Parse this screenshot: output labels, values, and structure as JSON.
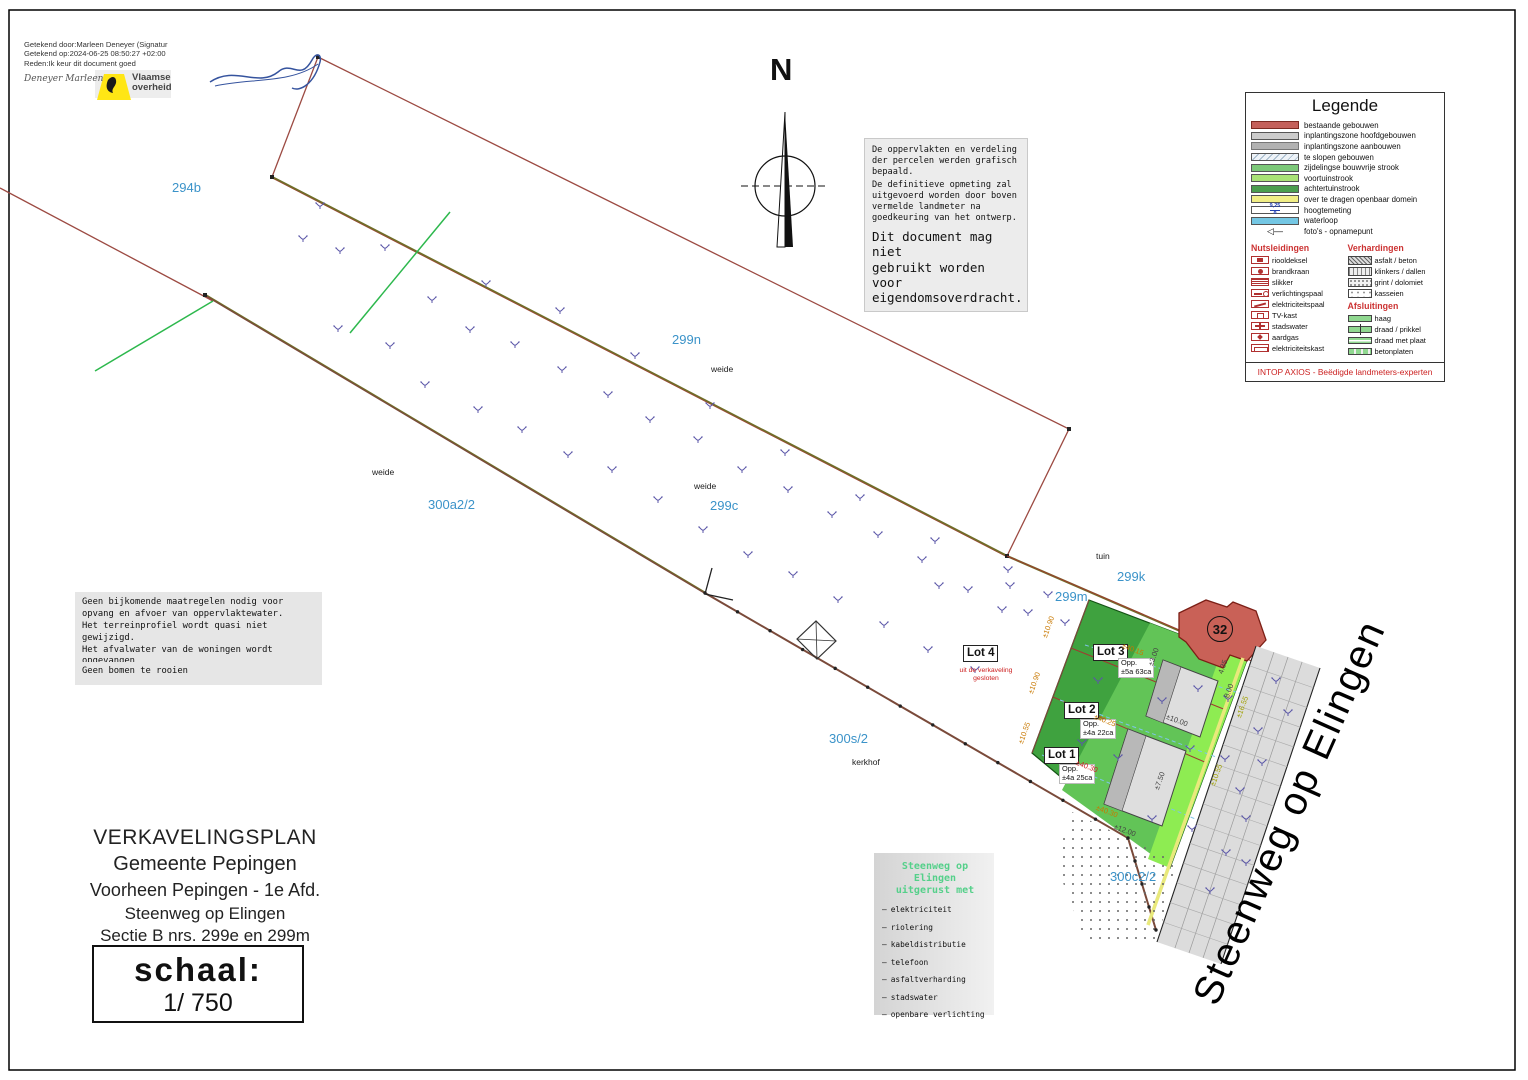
{
  "signature_block": {
    "lines": [
      "Getekend door:Marleen Deneyer (Signatur",
      "Getekend op:2024-06-25 08:50:27 +02:00",
      "Reden:Ik keur dit document goed"
    ],
    "handwritten_name": "Deneyer Marleen",
    "logo_line1": "Vlaamse",
    "logo_line2": "overheid"
  },
  "north": {
    "label": "N"
  },
  "notice_box": {
    "para1": "De oppervlakten en verdeling\nder percelen werden grafisch\nbepaald.",
    "para2": "De definitieve opmeting zal\nuitgevoerd worden door boven\nvermelde landmeter na\ngoedkeuring van het ontwerp.",
    "para3": "Dit document mag niet\ngebruikt worden voor\neigendomsoverdracht."
  },
  "legend": {
    "title": "Legende",
    "areas": [
      {
        "swatch": "sw-red",
        "label": "bestaande gebouwen"
      },
      {
        "swatch": "sw-gray1",
        "label": "inplantingszone hoofdgebouwen"
      },
      {
        "swatch": "sw-gray2",
        "label": "inplantingszone aanbouwen"
      },
      {
        "swatch": "sw-hatch",
        "label": "te slopen gebouwen"
      },
      {
        "swatch": "sw-green-mid",
        "label": "zijdelingse bouwvrije strook"
      },
      {
        "swatch": "sw-green-light",
        "label": "voortuinstrook"
      },
      {
        "swatch": "sw-green-dark",
        "label": "achtertuinstrook"
      },
      {
        "swatch": "sw-yellow",
        "label": "over te dragen openbaar domein"
      },
      {
        "swatch": "sw-hoogte",
        "note": "9,25|8",
        "label": "hoogtemeting"
      },
      {
        "swatch": "sw-blue",
        "label": "waterloop"
      },
      {
        "swatch": "sw-foto",
        "glyph": "◁—",
        "label": "foto's - opnamepunt"
      }
    ],
    "nutsleidingen": {
      "title": "Nutsleidingen",
      "items": [
        {
          "icon": "riooldeksel-icon",
          "cls": "ic-riool",
          "label": "riooldeksel"
        },
        {
          "icon": "brandkraan-icon",
          "cls": "ic-brand",
          "label": "brandkraan"
        },
        {
          "icon": "slikker-icon",
          "cls": "ic-slik",
          "label": "slikker"
        },
        {
          "icon": "verlichtingspaal-icon",
          "cls": "ic-verl",
          "label": "verlichtingspaal"
        },
        {
          "icon": "elektriciteitspaal-icon",
          "cls": "ic-epaal",
          "label": "elektriciteitspaal"
        },
        {
          "icon": "tv-kast-icon",
          "cls": "ic-tv",
          "label": "TV-kast"
        },
        {
          "icon": "stadswater-icon",
          "cls": "ic-water",
          "label": "stadswater"
        },
        {
          "icon": "aardgas-icon",
          "cls": "ic-gas",
          "label": "aardgas"
        },
        {
          "icon": "elektriciteitskast-icon",
          "cls": "ic-ekast",
          "label": "elektriciteitskast"
        }
      ]
    },
    "verhardingen": {
      "title": "Verhardingen",
      "items": [
        {
          "icon": "asfalt-beton-icon",
          "cls": "pat-hatch",
          "label": "asfalt / beton"
        },
        {
          "icon": "klinkers-dallen-icon",
          "cls": "pat-brick",
          "label": "klinkers / dallen"
        },
        {
          "icon": "grint-dolomiet-icon",
          "cls": "pat-dots",
          "label": "grint / dolomiet"
        },
        {
          "icon": "kasseien-icon",
          "cls": "pat-cobble",
          "label": "kasseien"
        }
      ]
    },
    "afsluitingen": {
      "title": "Afsluitingen",
      "items": [
        {
          "icon": "haag-icon",
          "cls": "",
          "label": "haag"
        },
        {
          "icon": "draad-prikkel-icon",
          "cls": "afs-draad",
          "label": "draad / prikkel"
        },
        {
          "icon": "draad-plaat-icon",
          "cls": "afs-plaat",
          "label": "draad met plaat"
        },
        {
          "icon": "betonplaten-icon",
          "cls": "afs-beton",
          "label": "betonplaten"
        }
      ]
    },
    "footer": "INTOP AXIOS - Beëdigde landmeters-experten"
  },
  "notes_box": {
    "para": "Geen bijkomende maatregelen nodig voor\nopvang en afvoer van oppervlaktewater.\nHet terreinprofiel wordt quasi niet gewijzigd.\nHet afvalwater van de woningen wordt opgevangen\nin de voorliggende riolering.",
    "para2": "Geen bomen te rooien"
  },
  "title_block": {
    "lines": [
      "VERKAVELINGSPLAN",
      "Gemeente Pepingen",
      "Voorheen Pepingen - 1e Afd.",
      "Steenweg op Elingen",
      "Sectie B nrs. 299e en 299m"
    ],
    "scale_label": "schaal:",
    "scale_value": "1/ 750"
  },
  "utilities_box": {
    "title_line1": "Steenweg op Elingen",
    "title_line2": "uitgerust met",
    "items": [
      "elektriciteit",
      "riolering",
      "kabeldistributie",
      "telefoon",
      "asfaltverharding",
      "stadswater",
      "openbare verlichting"
    ]
  },
  "map": {
    "street_label": {
      "text": "Steenweg op Elingen"
    },
    "building_number": "32",
    "labels": [
      {
        "text": "294b",
        "x": 172,
        "y": 180,
        "cls": "parcel"
      },
      {
        "text": "299n",
        "x": 672,
        "y": 332,
        "cls": "parcel"
      },
      {
        "text": "300a2/2",
        "x": 428,
        "y": 497,
        "cls": "parcel"
      },
      {
        "text": "299c",
        "x": 710,
        "y": 498,
        "cls": "parcel"
      },
      {
        "text": "299k",
        "x": 1117,
        "y": 569,
        "cls": "parcel"
      },
      {
        "text": "299m",
        "x": 1055,
        "y": 589,
        "cls": "parcel"
      },
      {
        "text": "300s/2",
        "x": 829,
        "y": 731,
        "cls": "parcel"
      },
      {
        "text": "300c2/2",
        "x": 1110,
        "y": 869,
        "cls": "parcel"
      },
      {
        "text": "weide",
        "x": 711,
        "y": 364,
        "cls": "landuse"
      },
      {
        "text": "weide",
        "x": 372,
        "y": 467,
        "cls": "landuse"
      },
      {
        "text": "weide",
        "x": 694,
        "y": 481,
        "cls": "landuse"
      },
      {
        "text": "tuin",
        "x": 1096,
        "y": 551,
        "cls": "landuse"
      },
      {
        "text": "kerkhof",
        "x": 852,
        "y": 757,
        "cls": "landuse"
      }
    ],
    "lots": [
      {
        "name": "Lot 3",
        "area_line1": "Opp.",
        "area_line2": "±5a 63ca",
        "name_x": 1093,
        "name_y": 644,
        "area_x": 1118,
        "area_y": 658
      },
      {
        "name": "Lot 2",
        "area_line1": "Opp.",
        "area_line2": "±4a 22ca",
        "name_x": 1064,
        "name_y": 702,
        "area_x": 1080,
        "area_y": 719
      },
      {
        "name": "Lot 1",
        "area_line1": "Opp.",
        "area_line2": "±4a 25ca",
        "name_x": 1044,
        "name_y": 747,
        "area_x": 1059,
        "area_y": 764
      }
    ],
    "lot4": {
      "name": "Lot 4",
      "note_line1": "uit de verkaveling",
      "note_line2": "gesloten",
      "x": 963,
      "y": 645
    },
    "measurements": [
      {
        "t": "±40.15",
        "x": 1124,
        "y": 641,
        "r": 21,
        "c": "#c87800"
      },
      {
        "t": "±40.25",
        "x": 1096,
        "y": 712,
        "r": 21,
        "c": "#c87800"
      },
      {
        "t": "±40.30",
        "x": 1078,
        "y": 758,
        "r": 21,
        "c": "#cc2020"
      },
      {
        "t": "±40.30",
        "x": 1098,
        "y": 803,
        "r": 21,
        "c": "#c87800"
      },
      {
        "t": "±10.00",
        "x": 1168,
        "y": 712,
        "r": 21,
        "c": "#444444"
      },
      {
        "t": "±12.00",
        "x": 1116,
        "y": 822,
        "r": 21,
        "c": "#444444"
      },
      {
        "t": "±16.55",
        "x": 1234,
        "y": 716,
        "r": -70,
        "c": "#a0a000"
      },
      {
        "t": "±10.55",
        "x": 1208,
        "y": 784,
        "r": -70,
        "c": "#a0a000"
      },
      {
        "t": "±10.90",
        "x": 1040,
        "y": 636,
        "r": -70,
        "c": "#c87800"
      },
      {
        "t": "±10.90",
        "x": 1026,
        "y": 692,
        "r": -70,
        "c": "#c87800"
      },
      {
        "t": "±10.55",
        "x": 1016,
        "y": 742,
        "r": -70,
        "c": "#c87800"
      },
      {
        "t": "±7.50",
        "x": 1152,
        "y": 788,
        "r": -70,
        "c": "#444444"
      },
      {
        "t": "±3.00",
        "x": 1146,
        "y": 664,
        "r": -70,
        "c": "#444444"
      },
      {
        "t": "8.00",
        "x": 1222,
        "y": 696,
        "r": -70,
        "c": "#444444"
      },
      {
        "t": "4.35",
        "x": 1216,
        "y": 672,
        "r": -70,
        "c": "#444444"
      }
    ],
    "markers": [
      [
        320,
        205
      ],
      [
        303,
        238
      ],
      [
        340,
        250
      ],
      [
        338,
        328
      ],
      [
        385,
        247
      ],
      [
        390,
        345
      ],
      [
        432,
        299
      ],
      [
        425,
        384
      ],
      [
        470,
        329
      ],
      [
        478,
        409
      ],
      [
        515,
        344
      ],
      [
        522,
        429
      ],
      [
        562,
        369
      ],
      [
        568,
        454
      ],
      [
        608,
        394
      ],
      [
        612,
        469
      ],
      [
        650,
        419
      ],
      [
        658,
        499
      ],
      [
        698,
        439
      ],
      [
        703,
        529
      ],
      [
        742,
        469
      ],
      [
        748,
        554
      ],
      [
        788,
        489
      ],
      [
        793,
        574
      ],
      [
        832,
        514
      ],
      [
        838,
        599
      ],
      [
        878,
        534
      ],
      [
        884,
        624
      ],
      [
        922,
        559
      ],
      [
        928,
        649
      ],
      [
        968,
        589
      ],
      [
        975,
        669
      ],
      [
        1002,
        609
      ],
      [
        939,
        585
      ],
      [
        1008,
        569
      ],
      [
        1048,
        594
      ],
      [
        1028,
        612
      ],
      [
        486,
        283
      ],
      [
        560,
        310
      ],
      [
        635,
        355
      ],
      [
        710,
        405
      ],
      [
        785,
        452
      ],
      [
        860,
        497
      ],
      [
        935,
        540
      ],
      [
        1010,
        585
      ],
      [
        1065,
        622
      ],
      [
        1098,
        680
      ],
      [
        1082,
        742
      ],
      [
        1118,
        757
      ],
      [
        1162,
        700
      ],
      [
        1198,
        688
      ],
      [
        1228,
        698
      ],
      [
        1190,
        748
      ],
      [
        1225,
        758
      ],
      [
        1152,
        818
      ],
      [
        1192,
        828
      ],
      [
        1240,
        790
      ],
      [
        1258,
        730
      ],
      [
        1276,
        680
      ],
      [
        1288,
        712
      ],
      [
        1262,
        762
      ],
      [
        1246,
        818
      ],
      [
        1226,
        852
      ],
      [
        1210,
        890
      ],
      [
        1246,
        862
      ]
    ]
  }
}
